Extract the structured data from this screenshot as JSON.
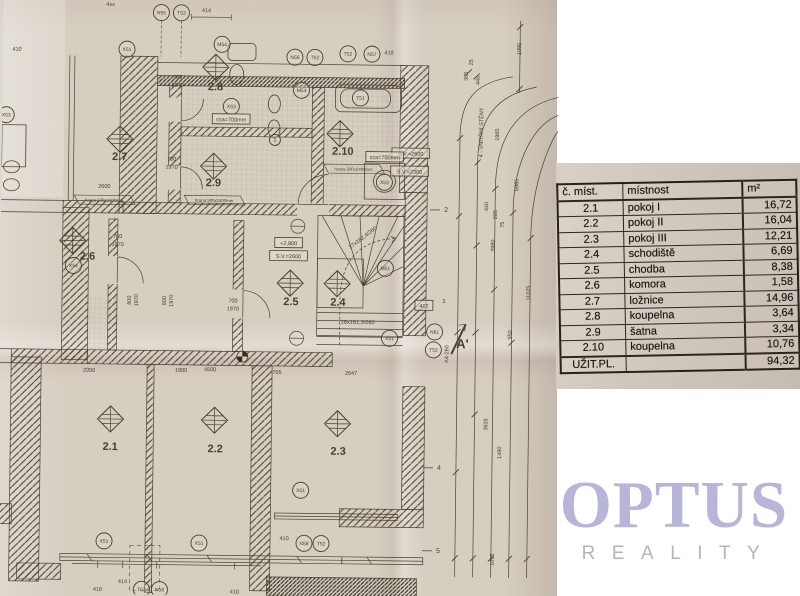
{
  "logo": {
    "name": "OPTUS",
    "subtitle": "REALITY",
    "color": "#b7b6d9",
    "subtitle_color": "#b5b5b5"
  },
  "area_table": {
    "headers": [
      "č. míst.",
      "místnost",
      "m²"
    ],
    "rows": [
      [
        "2.1",
        "pokoj I",
        "16,72"
      ],
      [
        "2.2",
        "pokoj II",
        "16,04"
      ],
      [
        "2.3",
        "pokoj III",
        "12,21"
      ],
      [
        "2.4",
        "schodiště",
        "6,69"
      ],
      [
        "2.5",
        "chodba",
        "8,38"
      ],
      [
        "2.6",
        "komora",
        "1,58"
      ],
      [
        "2.7",
        "ložnice",
        "14,96"
      ],
      [
        "2.8",
        "koupelna",
        "3,64"
      ],
      [
        "2.9",
        "šatna",
        "3,34"
      ],
      [
        "2.10",
        "koupelna",
        "10,76"
      ]
    ],
    "total": {
      "label": "UŽIT.PL.",
      "value": "94,32"
    }
  },
  "floor_plan": {
    "paper_color": "#d7cec2",
    "ink_color": "#45402f",
    "rooms": [
      {
        "id": "2.1",
        "x": 112,
        "y": 452,
        "dx": 112,
        "dy": 421
      },
      {
        "id": "2.2",
        "x": 217,
        "y": 453,
        "dx": 216,
        "dy": 421
      },
      {
        "id": "2.3",
        "x": 340,
        "y": 454,
        "dx": 339,
        "dy": 423
      },
      {
        "id": "2.4",
        "x": 338,
        "y": 305,
        "dx": 337,
        "dy": 283
      },
      {
        "id": "2.5",
        "x": 291,
        "y": 305,
        "dx": 290,
        "dy": 283
      },
      {
        "id": "2.6",
        "x": 87,
        "y": 262,
        "dx": 72,
        "dy": 243
      },
      {
        "id": "2.7",
        "x": 118,
        "y": 162,
        "dx": 118,
        "dy": 141
      },
      {
        "id": "2.8",
        "x": 213,
        "y": 91,
        "dx": 213,
        "dy": 68
      },
      {
        "id": "2.9",
        "x": 212,
        "y": 187,
        "dx": 212,
        "dy": 167
      },
      {
        "id": "2.10",
        "x": 341,
        "y": 154,
        "dx": 338,
        "dy": 133
      }
    ],
    "circled_labels": [
      {
        "t": "N55",
        "x": 158,
        "y": 14
      },
      {
        "t": "T52",
        "x": 178,
        "y": 14
      },
      {
        "t": "X51",
        "x": 124,
        "y": 51
      },
      {
        "t": "M54",
        "x": 219,
        "y": 45
      },
      {
        "t": "N56",
        "x": 292,
        "y": 57
      },
      {
        "t": "T52",
        "x": 312,
        "y": 57
      },
      {
        "t": "T52",
        "x": 345,
        "y": 53
      },
      {
        "t": "N57",
        "x": 369,
        "y": 53
      },
      {
        "t": "M54",
        "x": 299,
        "y": 90
      },
      {
        "t": "T51",
        "x": 358,
        "y": 97
      },
      {
        "t": "X53",
        "x": 229,
        "y": 107
      },
      {
        "t": "X53",
        "x": 383,
        "y": 181
      },
      {
        "t": "X53",
        "x": 4,
        "y": 118
      },
      {
        "t": "X54",
        "x": 73,
        "y": 268
      },
      {
        "t": "M51",
        "x": 385,
        "y": 267
      },
      {
        "t": "X51",
        "x": 390,
        "y": 337
      },
      {
        "t": "N61",
        "x": 435,
        "y": 330
      },
      {
        "t": "T52",
        "x": 434,
        "y": 348
      },
      {
        "t": "X51",
        "x": 303,
        "y": 490
      },
      {
        "t": "X51",
        "x": 107,
        "y": 543
      },
      {
        "t": "X51",
        "x": 202,
        "y": 544
      },
      {
        "t": "N58",
        "x": 307,
        "y": 543
      },
      {
        "t": "T52",
        "x": 324,
        "y": 543
      },
      {
        "t": "T52",
        "x": 145,
        "y": 591
      },
      {
        "t": "N58",
        "x": 163,
        "y": 591
      },
      {
        "t": "1",
        "x": 273,
        "y": 140
      }
    ],
    "boxed_labels": [
      {
        "t": "+2,800",
        "x": 288,
        "y": 243
      },
      {
        "t": "S.V.=2600",
        "x": 288,
        "y": 256
      },
      {
        "t": "S.V.=2600",
        "x": 409,
        "y": 152
      },
      {
        "t": "S.V.=2300",
        "x": 408,
        "y": 170
      },
      {
        "t": "412",
        "x": 424,
        "y": 304
      },
      {
        "t": "cca=700mm",
        "x": 229,
        "y": 120
      },
      {
        "t": "cca=700mm",
        "x": 383,
        "y": 156
      }
    ],
    "flag_labels": [
      {
        "t": "hrana 500x2400mm",
        "x": 103,
        "y": 202
      },
      {
        "t": "hrana 500x2400mm",
        "x": 213,
        "y": 201
      },
      {
        "t": "hrana 500x2400mm",
        "x": 352,
        "y": 168
      }
    ],
    "stair_notes": [
      {
        "t": "17x182,4/260",
        "x": 363,
        "y": 238,
        "r": -38
      },
      {
        "t": "16x161,3/260",
        "x": 358,
        "y": 323,
        "r": 0
      }
    ],
    "dims": [
      {
        "t": "410",
        "x": 14,
        "y": 54
      },
      {
        "t": "4xx",
        "x": 107,
        "y": 8
      },
      {
        "t": "414",
        "x": 203,
        "y": 13
      },
      {
        "t": "410",
        "x": 386,
        "y": 53
      },
      {
        "t": "2600",
        "x": 103,
        "y": 190
      },
      {
        "t": "700",
        "x": 175,
        "y": 80
      },
      {
        "t": "1970",
        "x": 175,
        "y": 88
      },
      {
        "t": "700",
        "x": 170,
        "y": 162
      },
      {
        "t": "1970",
        "x": 170,
        "y": 170
      },
      {
        "t": "700",
        "x": 117,
        "y": 240
      },
      {
        "t": "1970",
        "x": 117,
        "y": 248
      },
      {
        "t": "700",
        "x": 233,
        "y": 303
      },
      {
        "t": "1970",
        "x": 233,
        "y": 311
      },
      {
        "t": "2050",
        "x": 90,
        "y": 374
      },
      {
        "t": "1900",
        "x": 182,
        "y": 373
      },
      {
        "t": "4500",
        "x": 211,
        "y": 372
      },
      {
        "t": "705",
        "x": 278,
        "y": 374
      },
      {
        "t": "2647",
        "x": 352,
        "y": 374
      },
      {
        "t": "410",
        "x": 287,
        "y": 540
      },
      {
        "t": "414",
        "x": 126,
        "y": 585
      },
      {
        "t": "410",
        "x": 101,
        "y": 593
      },
      {
        "t": "410",
        "x": 238,
        "y": 594
      },
      {
        "t": "3",
        "x": 444,
        "y": 301
      }
    ],
    "dims_rotated": [
      {
        "t": "1095",
        "x": 518,
        "y": 46
      },
      {
        "t": "25",
        "x": 470,
        "y": 60
      },
      {
        "t": "385",
        "x": 465,
        "y": 74
      },
      {
        "t": "440",
        "x": 477,
        "y": 78
      },
      {
        "t": "1985",
        "x": 497,
        "y": 132
      },
      {
        "t": "6985",
        "x": 517,
        "y": 182
      },
      {
        "t": "440",
        "x": 487,
        "y": 204
      },
      {
        "t": "205",
        "x": 496,
        "y": 212
      },
      {
        "t": "75",
        "x": 503,
        "y": 222
      },
      {
        "t": "3980",
        "x": 494,
        "y": 243
      },
      {
        "t": "11025",
        "x": 530,
        "y": 290
      },
      {
        "t": "950",
        "x": 512,
        "y": 332
      },
      {
        "t": "3635",
        "x": 489,
        "y": 422
      },
      {
        "t": "1490",
        "x": 503,
        "y": 450
      },
      {
        "t": "1095",
        "x": 497,
        "y": 557
      },
      {
        "t": "800",
        "x": 131,
        "y": 302
      },
      {
        "t": "1970",
        "x": 138,
        "y": 302
      },
      {
        "t": "800",
        "x": 166,
        "y": 302
      },
      {
        "t": "1970",
        "x": 173,
        "y": 302
      },
      {
        "t": "A4-260",
        "x": 449,
        "y": 352
      }
    ],
    "ref_marks": [
      {
        "t": "2",
        "x": 445,
        "y": 210
      },
      {
        "t": "4",
        "x": 441,
        "y": 468
      },
      {
        "t": "5",
        "x": 441,
        "y": 551
      }
    ],
    "section_marker": {
      "label": "A'",
      "x": 463,
      "y": 346
    },
    "side_note": {
      "t": "4 - VNITŘNÍ STĚNY",
      "x": 481,
      "y": 130
    }
  }
}
